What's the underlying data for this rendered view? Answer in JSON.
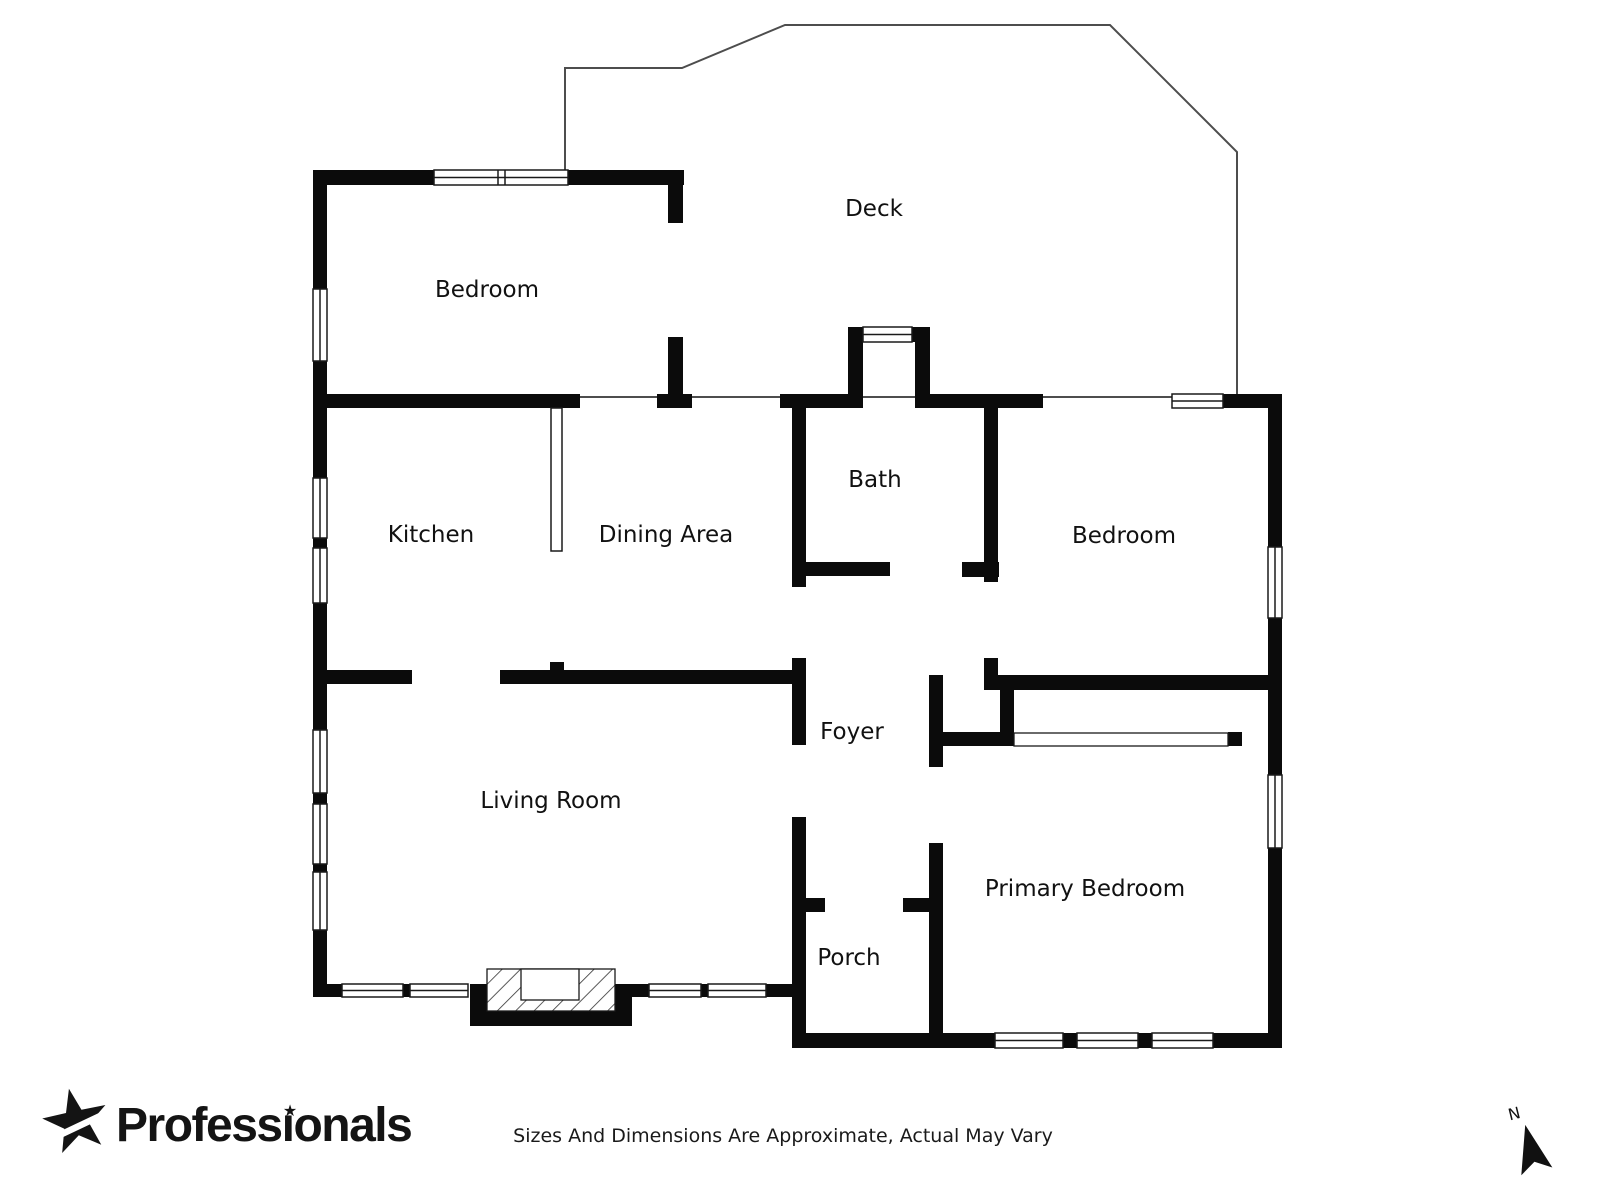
{
  "rooms": {
    "deck": "Deck",
    "bedroom_top_left": "Bedroom",
    "kitchen": "Kitchen",
    "dining_area": "Dining Area",
    "bath": "Bath",
    "bedroom_right": "Bedroom",
    "foyer": "Foyer",
    "living_room": "Living Room",
    "primary_bedroom": "Primary Bedroom",
    "porch": "Porch"
  },
  "branding": {
    "logo_text": "Professionals",
    "logo_prefix": "Profess",
    "logo_dotless_i": "ı",
    "logo_suffix": "onals",
    "star_icon": "★"
  },
  "footer": {
    "disclaimer": "Sizes And Dimensions Are Approximate, Actual May Vary"
  },
  "compass": {
    "north_label": "N"
  },
  "colors": {
    "wall": "#0b0b0b",
    "deck_outline": "#4d4d4d",
    "window_frame": "#1a1a1a",
    "label_text": "#111111",
    "background": "#ffffff"
  }
}
